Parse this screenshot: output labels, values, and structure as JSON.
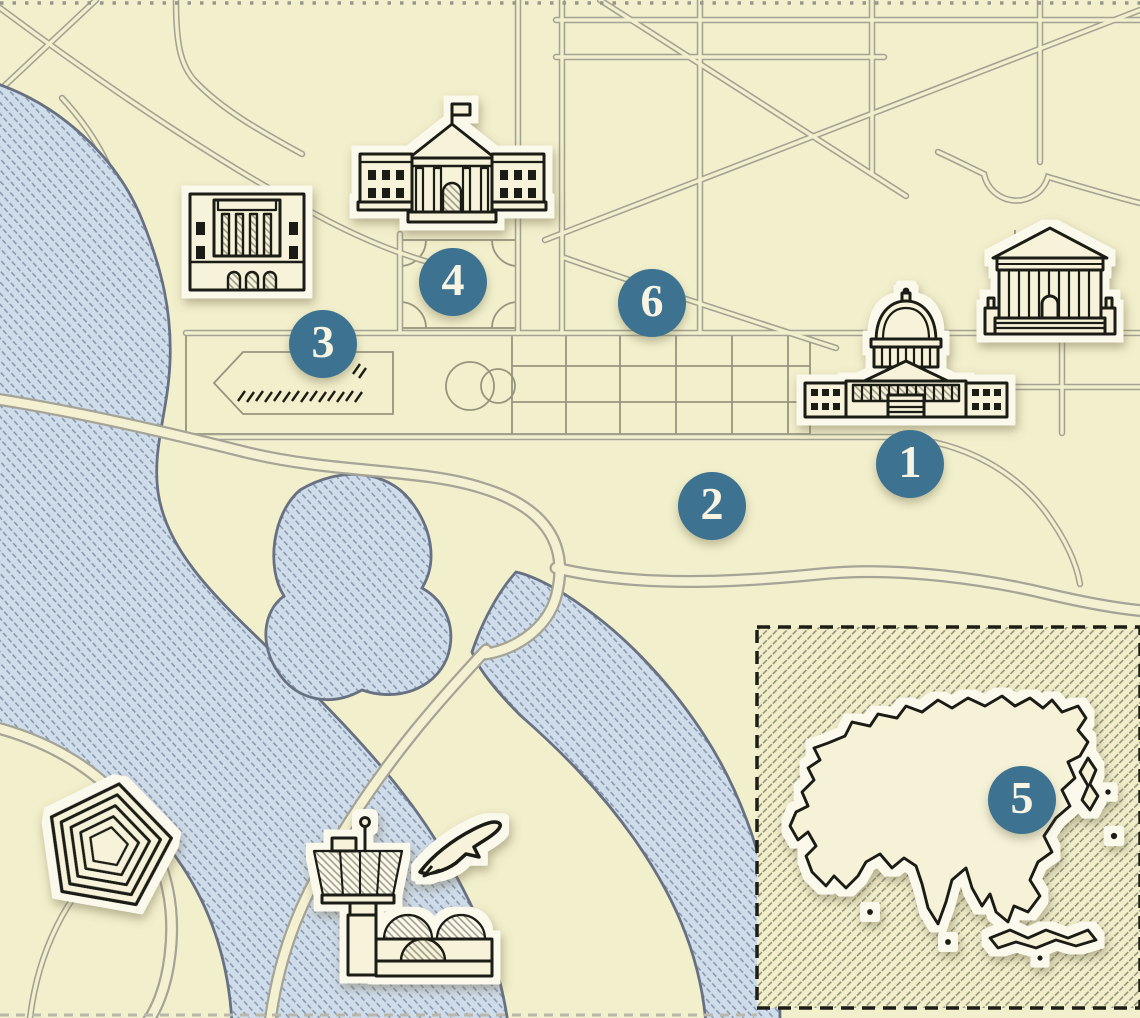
{
  "map": {
    "title": "Illustrated Washington DC landmarks map",
    "markers": [
      {
        "label": "1"
      },
      {
        "label": "2"
      },
      {
        "label": "3"
      },
      {
        "label": "4"
      },
      {
        "label": "5"
      },
      {
        "label": "6"
      }
    ],
    "icons": [
      "memorial-building-icon",
      "white-house-icon",
      "capitol-icon",
      "supreme-court-icon",
      "pentagon-icon",
      "airport-tower-icon",
      "airplane-icon",
      "asia-continent-shape"
    ],
    "colors": {
      "background": "#f2efcc",
      "mall": "#e9e5c2",
      "water_fill": "#cfdcea",
      "water_hatch": "#8a9ab0",
      "road": "#a3a293",
      "ink": "#1d1d15",
      "marker": "#3d7391",
      "marker_text": "#f7f4e4"
    }
  }
}
